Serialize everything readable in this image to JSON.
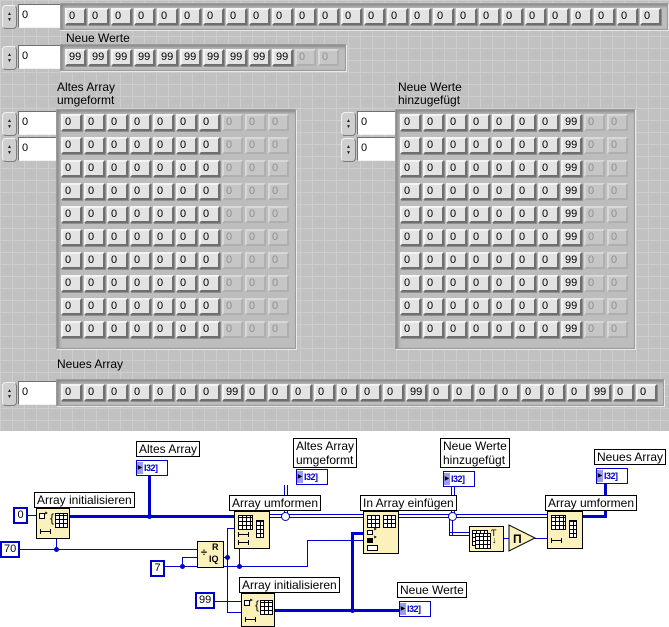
{
  "panel": {
    "altes_array_row": {
      "index": "0",
      "values": [
        "0",
        "0",
        "0",
        "0",
        "0",
        "0",
        "0",
        "0",
        "0",
        "0",
        "0",
        "0",
        "0",
        "0",
        "0",
        "0",
        "0",
        "0",
        "0",
        "0",
        "0",
        "0",
        "0",
        "0",
        "0",
        "0"
      ]
    },
    "neue_werte_row": {
      "label": "Neue Werte",
      "index": "0",
      "values": [
        "99",
        "99",
        "99",
        "99",
        "99",
        "99",
        "99",
        "99",
        "99",
        "99",
        "0",
        "0"
      ],
      "disabled_from": 10
    },
    "altes_umgeformt_grid": {
      "label_lines": [
        "Altes Array",
        "umgeformt"
      ],
      "index_row": "0",
      "index_col": "0",
      "rows": 10,
      "cols": [
        "0",
        "0",
        "0",
        "0",
        "0",
        "0",
        "0",
        "0",
        "0",
        "0"
      ],
      "disabled_cols": [
        7,
        8,
        9
      ]
    },
    "neue_hinzugefuegt_grid": {
      "label_lines": [
        "Neue Werte",
        "hinzugefügt"
      ],
      "index_row": "0",
      "index_col": "0",
      "rows": 10,
      "cols": [
        "0",
        "0",
        "0",
        "0",
        "0",
        "0",
        "0",
        "99",
        "0",
        "0"
      ],
      "disabled_cols": [
        8,
        9
      ]
    },
    "neues_array_row": {
      "label": "Neues Array",
      "index": "0",
      "values": [
        "0",
        "0",
        "0",
        "0",
        "0",
        "0",
        "0",
        "99",
        "0",
        "0",
        "0",
        "0",
        "0",
        "0",
        "0",
        "99",
        "0",
        "0",
        "0",
        "0",
        "0",
        "0",
        "0",
        "99",
        "0",
        "0"
      ]
    },
    "spinner_up": "▲",
    "spinner_down": "▼"
  },
  "diagram": {
    "terminal_text": "I32]",
    "terminal_arrow": "▶",
    "indicators": {
      "altes_array": "Altes Array",
      "altes_umgeformt_lines": [
        "Altes Array",
        "umgeformt"
      ],
      "neue_hinzu_lines": [
        "Neue Werte",
        "hinzugefügt"
      ],
      "neue_werte": "Neue Werte",
      "neues_array": "Neues Array"
    },
    "nodes": {
      "init1_label": "Array initialisieren",
      "umformen1_label": "Array umformen",
      "einfuegen_label": "In Array einfügen",
      "init2_label": "Array initialisieren",
      "umformen2_label": "Array umformen",
      "riq_div": "÷",
      "riq_r": "R",
      "riq_iq": "IQ",
      "pi_symbol": "Π"
    },
    "constants": {
      "zero": "0",
      "seventy": "70",
      "seven": "7",
      "ninetynine": "99"
    }
  },
  "colors": {
    "wire": "#0000cd",
    "panel_background": "#c1c1c1",
    "node_fill": "#fbf1bd",
    "terminal_accent": "#9a9af2"
  }
}
